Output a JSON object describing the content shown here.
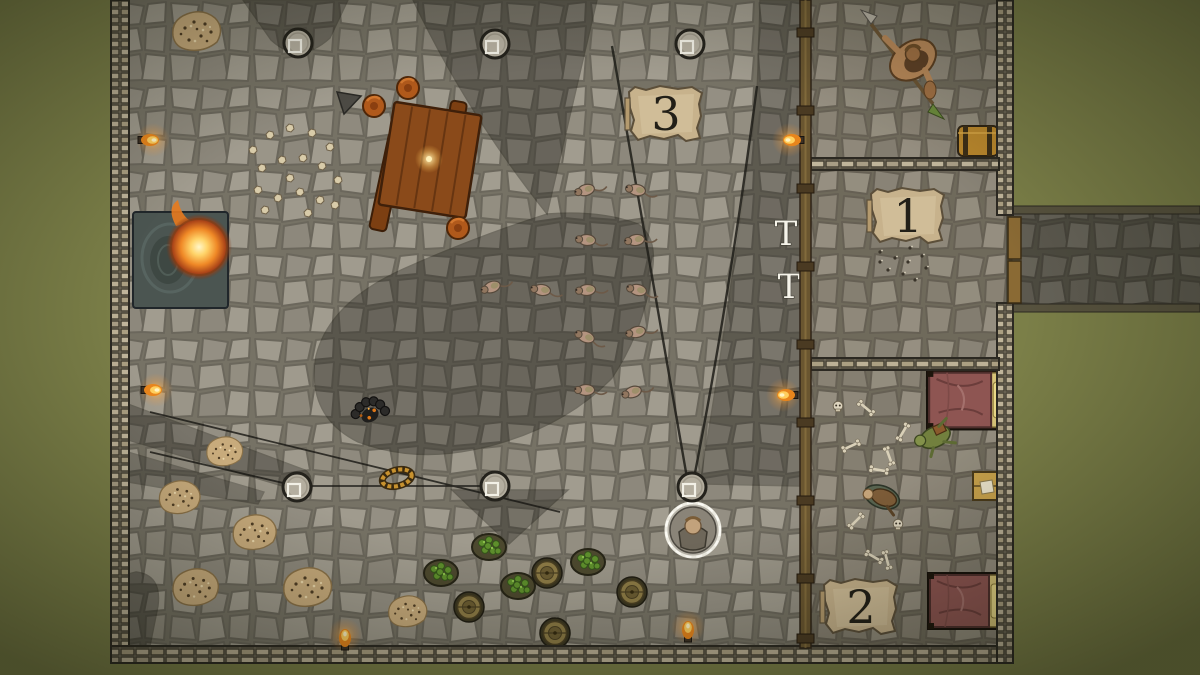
{
  "scene": {
    "description": "Top-down fantasy tavern dungeon battle map, virtual tabletop view",
    "colors": {
      "grass": "#7b7f48",
      "floor_stone": "#99948a",
      "shadow": "#26241f",
      "wall_stone": "#b2a890",
      "wood": "#8a6a34",
      "parchment": "#c7b28c",
      "flame": "#f0a028",
      "bed_blanket": "#8e5552",
      "hops_green": "#5e8f2c"
    }
  },
  "room_markers": [
    {
      "label": "3",
      "x": 666,
      "y": 114
    },
    {
      "label": "1",
      "x": 908,
      "y": 216
    },
    {
      "label": "2",
      "x": 861,
      "y": 607
    }
  ],
  "wall_glyphs": [
    {
      "label": "T",
      "x": 786,
      "y": 245
    },
    {
      "label": "T",
      "x": 789,
      "y": 298
    }
  ],
  "creatures": {
    "rats": [
      {
        "x": 586,
        "y": 190,
        "r": -15
      },
      {
        "x": 637,
        "y": 190,
        "r": 10
      },
      {
        "x": 587,
        "y": 240,
        "r": 5
      },
      {
        "x": 636,
        "y": 240,
        "r": -8
      },
      {
        "x": 492,
        "y": 287,
        "r": -20
      },
      {
        "x": 542,
        "y": 290,
        "r": 8
      },
      {
        "x": 587,
        "y": 290,
        "r": -5
      },
      {
        "x": 638,
        "y": 290,
        "r": 12
      },
      {
        "x": 586,
        "y": 337,
        "r": 20
      },
      {
        "x": 637,
        "y": 332,
        "r": -12
      },
      {
        "x": 586,
        "y": 390,
        "r": 0
      },
      {
        "x": 633,
        "y": 392,
        "r": -18
      }
    ],
    "barbarian": {
      "x": 913,
      "y": 60
    },
    "player": {
      "x": 693,
      "y": 530
    },
    "dead_goblin": {
      "x": 935,
      "y": 437
    },
    "dead_adventurer": {
      "x": 882,
      "y": 497
    },
    "dark_figure": {
      "x": 370,
      "y": 415
    }
  },
  "objects": {
    "pillars": [
      [
        298,
        43
      ],
      [
        495,
        44
      ],
      [
        690,
        44
      ],
      [
        297,
        487
      ],
      [
        495,
        486
      ],
      [
        692,
        487
      ]
    ],
    "torches": [
      {
        "x": 147,
        "y": 140,
        "r": 0
      },
      {
        "x": 150,
        "y": 390,
        "r": 0
      },
      {
        "x": 795,
        "y": 140,
        "r": 180
      },
      {
        "x": 789,
        "y": 395,
        "r": 180
      },
      {
        "x": 345,
        "y": 641,
        "r": -90
      },
      {
        "x": 688,
        "y": 633,
        "r": -90
      }
    ],
    "barrels_top": [
      [
        547,
        573
      ],
      [
        469,
        607
      ],
      [
        555,
        633
      ],
      [
        632,
        592
      ]
    ],
    "hop_sacks": [
      [
        441,
        573
      ],
      [
        489,
        547
      ],
      [
        518,
        586
      ],
      [
        588,
        562
      ]
    ],
    "rubble": [
      {
        "x": 197,
        "y": 32,
        "s": 1.0
      },
      {
        "x": 225,
        "y": 452,
        "s": 0.75
      },
      {
        "x": 180,
        "y": 498,
        "s": 0.85
      },
      {
        "x": 255,
        "y": 533,
        "s": 0.9
      },
      {
        "x": 196,
        "y": 588,
        "s": 0.95
      },
      {
        "x": 308,
        "y": 588,
        "s": 1.0
      },
      {
        "x": 408,
        "y": 612,
        "s": 0.8
      }
    ],
    "stone_scatter": [
      [
        253,
        150
      ],
      [
        270,
        135
      ],
      [
        290,
        128
      ],
      [
        312,
        133
      ],
      [
        330,
        147
      ],
      [
        262,
        168
      ],
      [
        282,
        160
      ],
      [
        303,
        158
      ],
      [
        322,
        166
      ],
      [
        338,
        180
      ],
      [
        258,
        190
      ],
      [
        278,
        198
      ],
      [
        300,
        192
      ],
      [
        320,
        200
      ],
      [
        290,
        178
      ],
      [
        335,
        205
      ],
      [
        265,
        210
      ],
      [
        308,
        213
      ]
    ],
    "debris_specks": [
      [
        880,
        252
      ],
      [
        895,
        258
      ],
      [
        908,
        262
      ],
      [
        922,
        256
      ],
      [
        888,
        270
      ],
      [
        903,
        274
      ],
      [
        915,
        280
      ],
      [
        880,
        262
      ],
      [
        926,
        268
      ],
      [
        910,
        248
      ]
    ],
    "skulls": [
      [
        838,
        406
      ],
      [
        898,
        524
      ]
    ],
    "bones": [
      {
        "x": 866,
        "y": 408,
        "r": 40
      },
      {
        "x": 851,
        "y": 446,
        "r": -25
      },
      {
        "x": 889,
        "y": 456,
        "r": 70
      },
      {
        "x": 879,
        "y": 470,
        "r": 10
      },
      {
        "x": 856,
        "y": 521,
        "r": -45
      },
      {
        "x": 874,
        "y": 557,
        "r": 30
      },
      {
        "x": 903,
        "y": 432,
        "r": -60
      },
      {
        "x": 887,
        "y": 560,
        "r": 75
      }
    ],
    "beds": [
      {
        "x": 968,
        "y": 400,
        "s": 1.05
      },
      {
        "x": 967,
        "y": 601,
        "s": 1.0
      }
    ],
    "stools": [
      [
        408,
        88
      ],
      [
        374,
        106
      ],
      [
        458,
        228
      ]
    ]
  }
}
